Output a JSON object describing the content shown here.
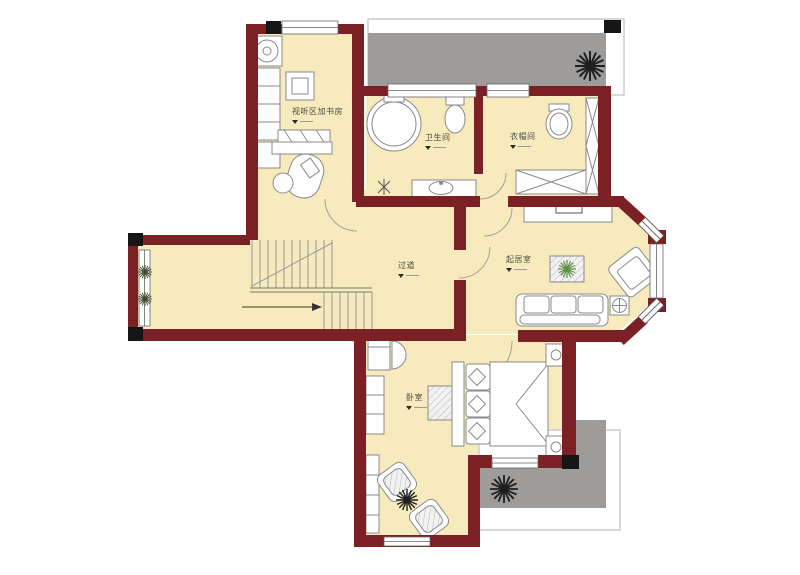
{
  "plan": {
    "type": "residential-floor-plan",
    "rooms": [
      {
        "id": "study",
        "label": "视听区加书房"
      },
      {
        "id": "bathroom",
        "label": "卫生间"
      },
      {
        "id": "cloakroom",
        "label": "衣帽间"
      },
      {
        "id": "hallway",
        "label": "过道"
      },
      {
        "id": "living-room",
        "label": "起居室"
      },
      {
        "id": "bedroom",
        "label": "卧室"
      }
    ],
    "colors": {
      "wall": "#7b2125",
      "column": "#161616",
      "floor": "#f7ebbd",
      "terrace": "#9d9c9a",
      "terrace_outline": "#cccccc",
      "furniture_line": "#8a8a8a",
      "stair_line": "#9a9a9a",
      "plant_dark": "#1e1e1e",
      "plant_green": "#5e8f46"
    },
    "icons": {
      "plant": "burst-star",
      "direction_arrow": "right-arrow",
      "label_marker": "down-triangle-with-dash"
    }
  }
}
